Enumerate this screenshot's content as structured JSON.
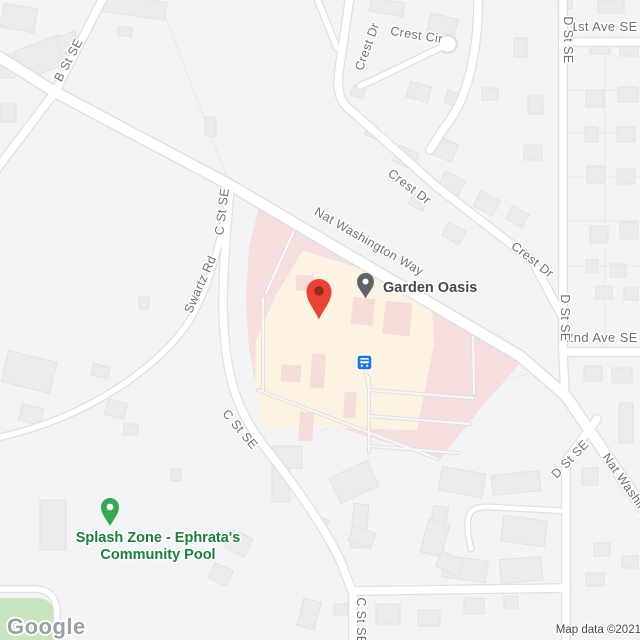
{
  "streets": {
    "b_st_se": "B St SE",
    "c_st_se": "C St SE",
    "swartz_rd": "Swartz Rd",
    "crest_dr": "Crest Dr",
    "crest_cir": "Crest Cir",
    "first_ave_se": "1st Ave SE",
    "second_ave_se": "2nd Ave SE",
    "d_st_se": "D St SE",
    "nat_washington_way": "Nat Washington Way"
  },
  "pois": {
    "garden_oasis": {
      "label": "Garden Oasis"
    },
    "splash_zone": {
      "label_line1": "Splash Zone - Ephrata's",
      "label_line2": "Community Pool"
    }
  },
  "footer": {
    "logo_text": "Google",
    "attribution": "Map data ©2021"
  },
  "colors": {
    "land": "#f3f4f5",
    "road_fill": "#ffffff",
    "road_casing": "#dee0e2",
    "building": "#e9ebec",
    "hospital_area": "#f6dede",
    "hospital_building": "#fdf3e3",
    "hospital_building_dark": "#f5dcd8",
    "park_green": "#c8e5bf",
    "marker_red": "#ea4335",
    "marker_red_dot": "#952a1e",
    "poi_pin_gray": "#5f6368",
    "poi_label_gray": "#45494d",
    "poi_label_green": "#188038",
    "poi_pin_green": "#34a853",
    "transit_blue": "#1a73e8",
    "street_label": "#6d7176"
  }
}
